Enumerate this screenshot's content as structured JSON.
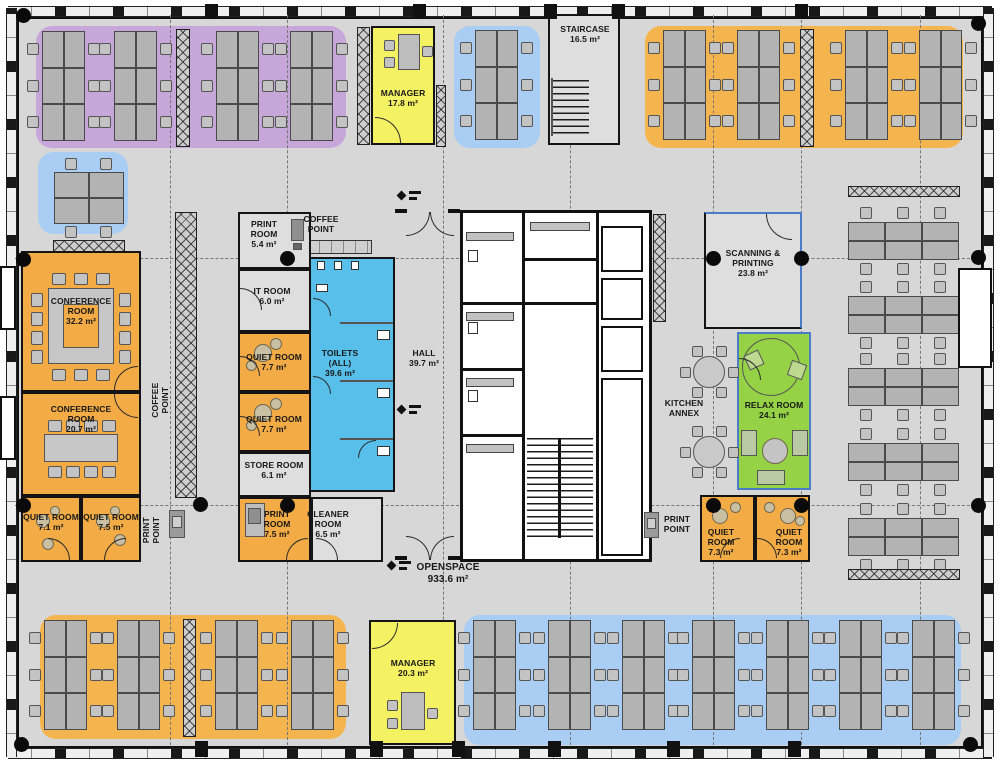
{
  "colors": {
    "floor": "#d7d7d7",
    "wall": "#141414",
    "zone_purple": "#c7a7da",
    "zone_blue": "#a9cdf3",
    "zone_orange": "#f5b54e",
    "room_orange": "#f2ab45",
    "room_yellow": "#f4f163",
    "room_gray": "#dedede",
    "toilets_blue": "#57bfe9",
    "relax_green": "#96d245",
    "steel_blue_wall": "#4a7cc7",
    "desk": "#b3b3b3",
    "chair": "#c3c3c3",
    "pouf": "#c9bfa3"
  },
  "rooms": {
    "staircase": {
      "name": "STAIRCASE",
      "area": "16.5 m²"
    },
    "manager_top": {
      "name": "MANAGER",
      "area": "17.8 m²"
    },
    "conference_1": {
      "name": "CONFERENCE ROOM",
      "area": "32.2 m²"
    },
    "conference_2": {
      "name": "CONFERENCE ROOM",
      "area": "20.7 m²"
    },
    "quiet_71": {
      "name": "QUIET ROOM",
      "area": "7.1 m²"
    },
    "quiet_75": {
      "name": "QUIET ROOM",
      "area": "7.5 m²"
    },
    "print_top": {
      "name": "PRINT ROOM",
      "area": "5.4 m²"
    },
    "it_room": {
      "name": "IT ROOM",
      "area": "6.0 m²"
    },
    "quiet_77a": {
      "name": "QUIET ROOM",
      "area": "7.7 m²"
    },
    "quiet_77b": {
      "name": "QUIET ROOM",
      "area": "7.7 m²"
    },
    "store": {
      "name": "STORE ROOM",
      "area": "6.1 m²"
    },
    "print_bottom": {
      "name": "PRINT ROOM",
      "area": "7.5 m²"
    },
    "cleaner": {
      "name": "CLEANER ROOM",
      "area": "6.5 m²"
    },
    "toilets": {
      "name": "TOILETS (ALL)",
      "area": "39.6 m²"
    },
    "hall": {
      "name": "HALL",
      "area": "39.7 m²"
    },
    "scanning": {
      "name": "SCANNING & PRINTING",
      "area": "23.8 m²"
    },
    "relax": {
      "name": "RELAX ROOM",
      "area": "24.1 m²"
    },
    "kitchen_annex": {
      "name": "KITCHEN ANNEX",
      "area": ""
    },
    "quiet_73a": {
      "name": "QUIET ROOM",
      "area": "7.3 m²"
    },
    "quiet_73b": {
      "name": "QUIET ROOM",
      "area": "7.3 m²"
    },
    "manager_bottom": {
      "name": "MANAGER",
      "area": "20.3 m²"
    },
    "openspace": {
      "name": "OPENSPACE",
      "area": "933.6 m²"
    }
  },
  "points": {
    "coffee_top": "COFFEE POINT",
    "coffee_left": "COFFEE POINT",
    "print_left": "PRINT POINT",
    "print_right": "PRINT POINT"
  }
}
